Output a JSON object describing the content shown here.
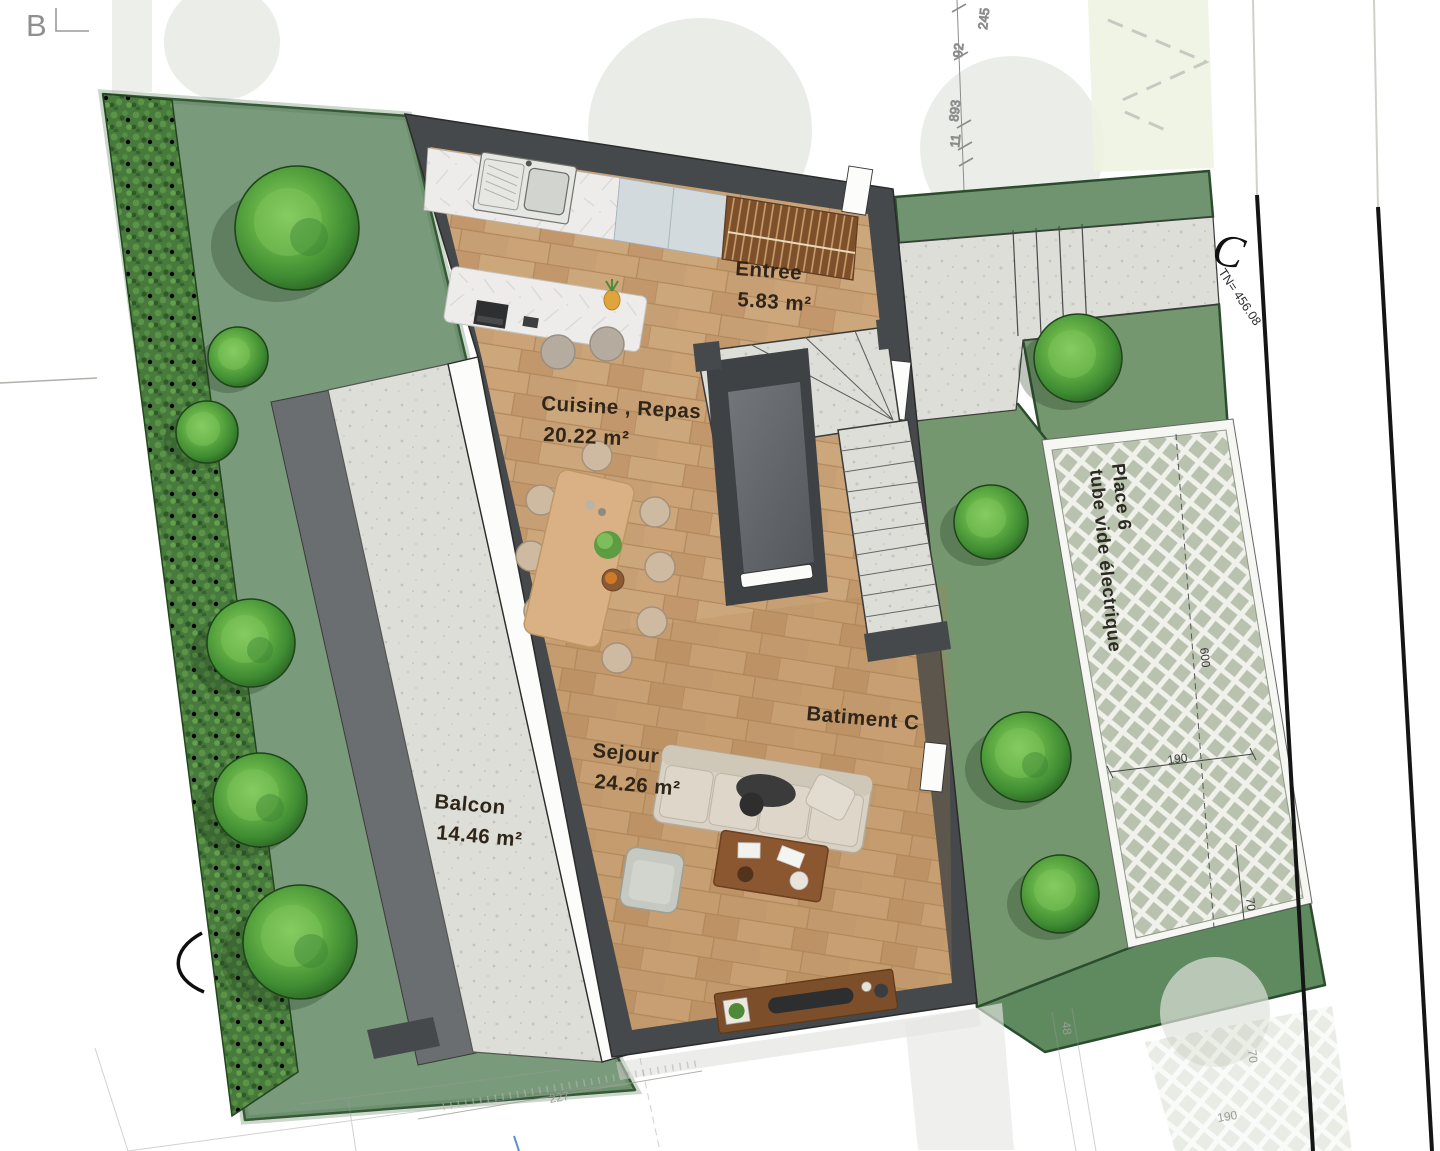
{
  "markers": {
    "b": "B",
    "c": "C",
    "tn": "TN= 456.08"
  },
  "rooms": {
    "entree": {
      "name": "Entree",
      "area": "5.83 m²"
    },
    "cuisine": {
      "name": "Cuisine , Repas",
      "area": "20.22 m²"
    },
    "sejour": {
      "name": "Sejour",
      "area": "24.26 m²"
    },
    "balcon": {
      "name": "Balcon",
      "area": "14.46 m²"
    }
  },
  "building": {
    "label": "Batiment C"
  },
  "parking": {
    "line1": "Place 6",
    "line2": "tube vide électrique"
  },
  "dimensions": {
    "top_chain": [
      "245",
      "92",
      "893",
      "11"
    ],
    "parking": {
      "depth": "600",
      "width": "190",
      "offset": "70"
    },
    "ghost": {
      "width": "227",
      "left": "48",
      "offset": "70",
      "width2": "190"
    }
  },
  "colors": {
    "lawn": "#7a9a7c",
    "hedge": "#477a3c",
    "tree": "#4f9a3b",
    "wall": "#46494b",
    "wood_floor": "#c79f74",
    "concrete": "#ddded8",
    "lattice": "#b9c2ae",
    "label_text": "#2f2619"
  }
}
